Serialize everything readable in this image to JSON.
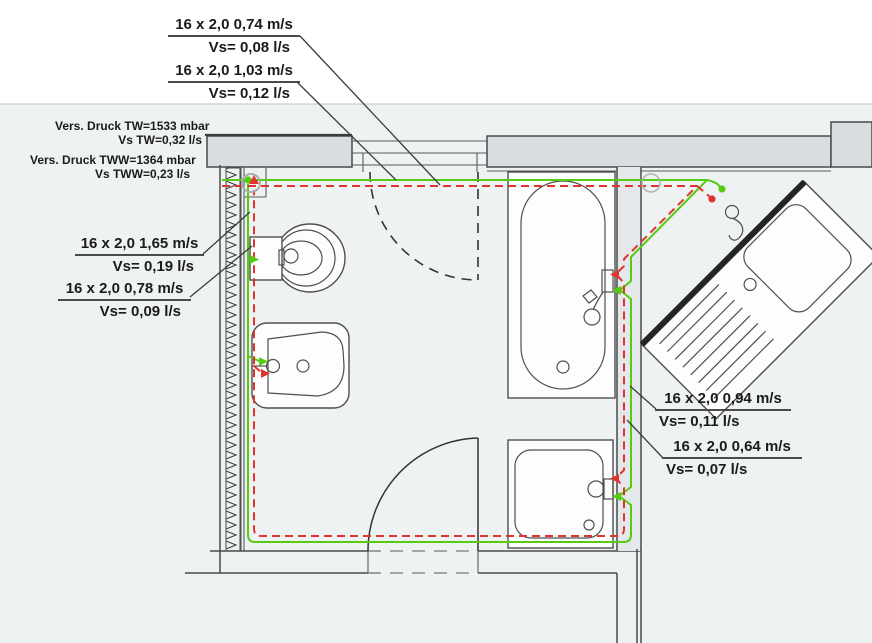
{
  "drawing": {
    "kind": "sanitary piping floor plan",
    "annotations": {
      "pipe_top_1": {
        "line1": "16 x 2,0 0,74 m/s",
        "line2": "Vs= 0,08 l/s"
      },
      "pipe_top_2": {
        "line1": "16 x 2,0 1,03 m/s",
        "line2": "Vs= 0,12 l/s"
      },
      "supply_pressure_cold": {
        "line1": "Vers. Druck TW=1533 mbar",
        "line2": "Vs TW=0,32 l/s"
      },
      "supply_pressure_hot": {
        "line1": "Vers. Druck TWW=1364 mbar",
        "line2": "Vs TWW=0,23 l/s"
      },
      "pipe_left_1": {
        "line1": "16 x 2,0 1,65 m/s",
        "line2": "Vs= 0,19 l/s"
      },
      "pipe_left_2": {
        "line1": "16 x 2,0 0,78 m/s",
        "line2": "Vs= 0,09 l/s"
      },
      "pipe_right_1": {
        "line1": "16 x 2,0 0,94 m/s",
        "line2": "Vs= 0,11 l/s"
      },
      "pipe_right_2": {
        "line1": "16 x 2,0 0,64 m/s",
        "line2": "Vs= 0,07 l/s"
      }
    },
    "colors": {
      "cold_water_pipe": "#55cc11",
      "hot_water_pipe": "#e0352f",
      "wall_fill": "#d9dde0",
      "line": "#3c3c3c"
    }
  }
}
